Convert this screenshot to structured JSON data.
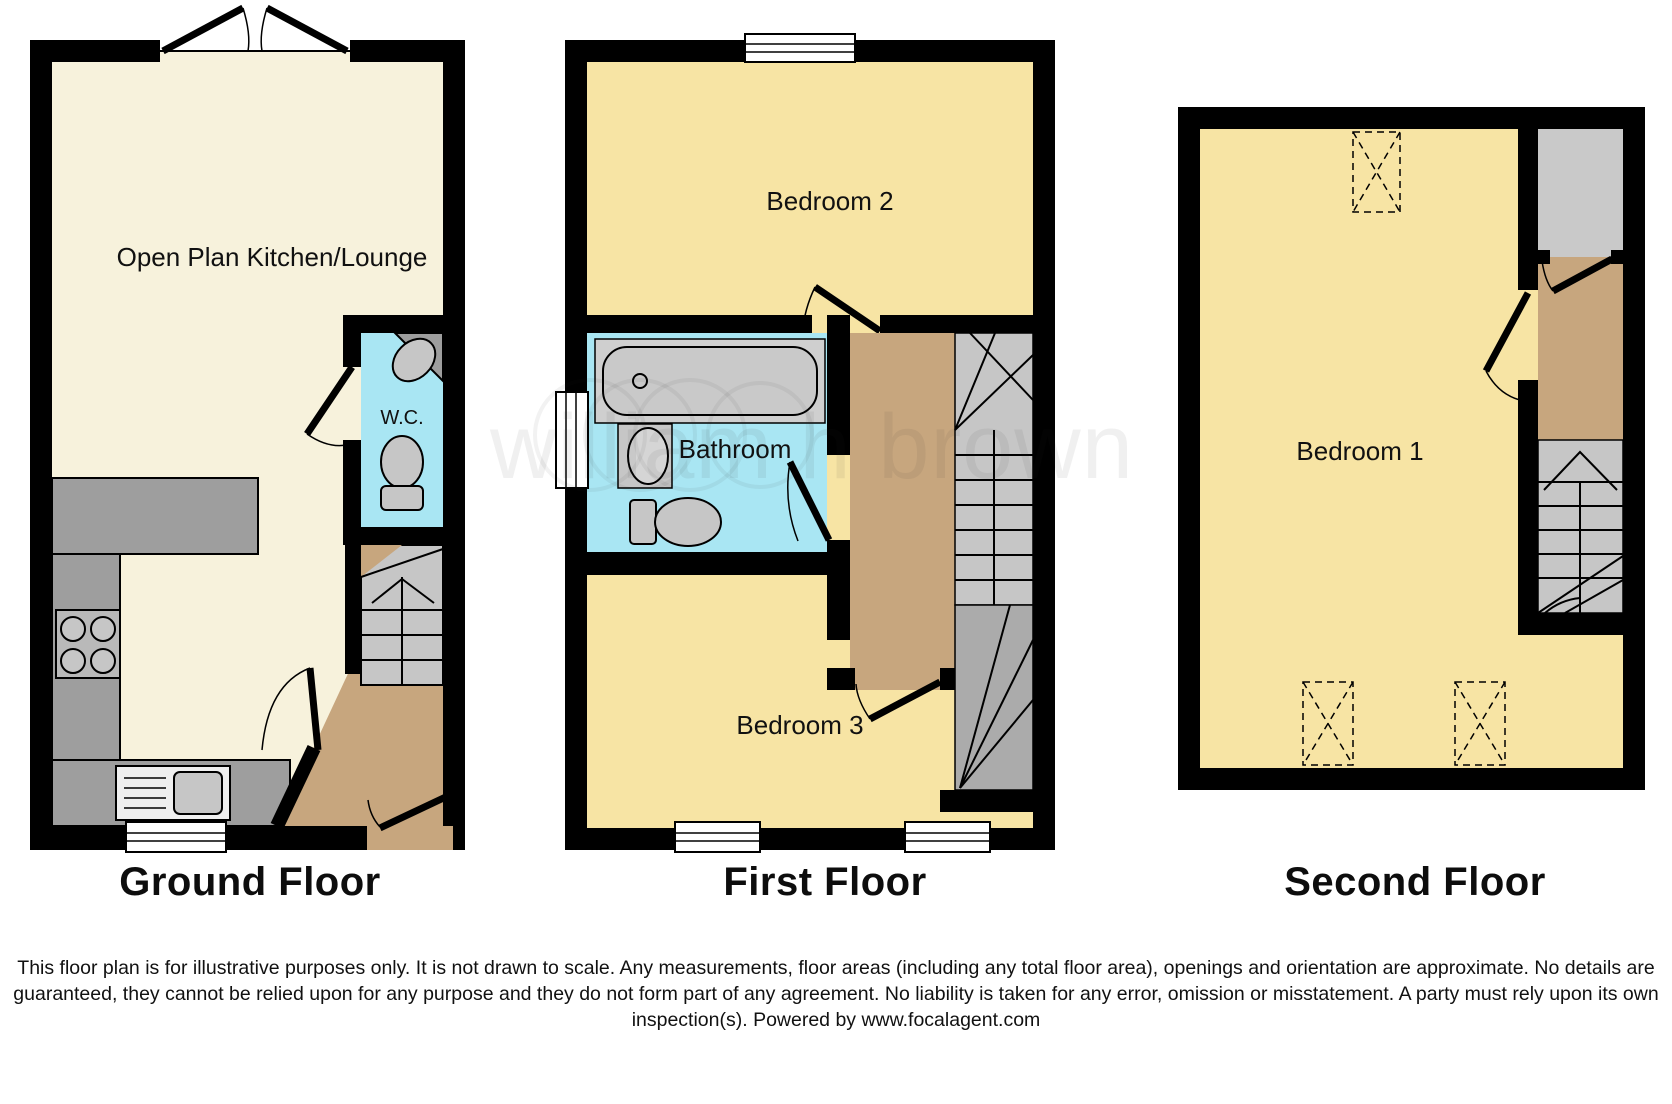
{
  "floors": [
    {
      "label": "Ground Floor",
      "rooms": [
        {
          "name": "Open Plan Kitchen/Lounge"
        },
        {
          "name": "W.C."
        }
      ]
    },
    {
      "label": "First Floor",
      "rooms": [
        {
          "name": "Bedroom 2"
        },
        {
          "name": "Bathroom"
        },
        {
          "name": "Bedroom 3"
        }
      ]
    },
    {
      "label": "Second Floor",
      "rooms": [
        {
          "name": "Bedroom 1"
        }
      ]
    }
  ],
  "watermark": "william h brown",
  "disclaimer": "This floor plan is for illustrative purposes only. It is not drawn to scale. Any measurements, floor areas (including any total floor area), openings and orientation are approximate. No details are guaranteed, they cannot be relied upon for any purpose and they do not form part of any agreement. No liability is taken for any error, omission or misstatement. A party must rely upon its own inspection(s). Powered by www.focalagent.com",
  "colors": {
    "wall": "#000000",
    "lounge_cream": "#F7F2DC",
    "bedroom_yellow": "#F7E4A4",
    "wet_room_blue": "#A9E6F3",
    "landing_brown": "#C7A67E",
    "stair_gray_light": "#C6C6C6",
    "stair_gray_dark": "#ABABAB",
    "counter_gray": "#9E9E9E",
    "fixture_gray": "#C6C6C6"
  }
}
